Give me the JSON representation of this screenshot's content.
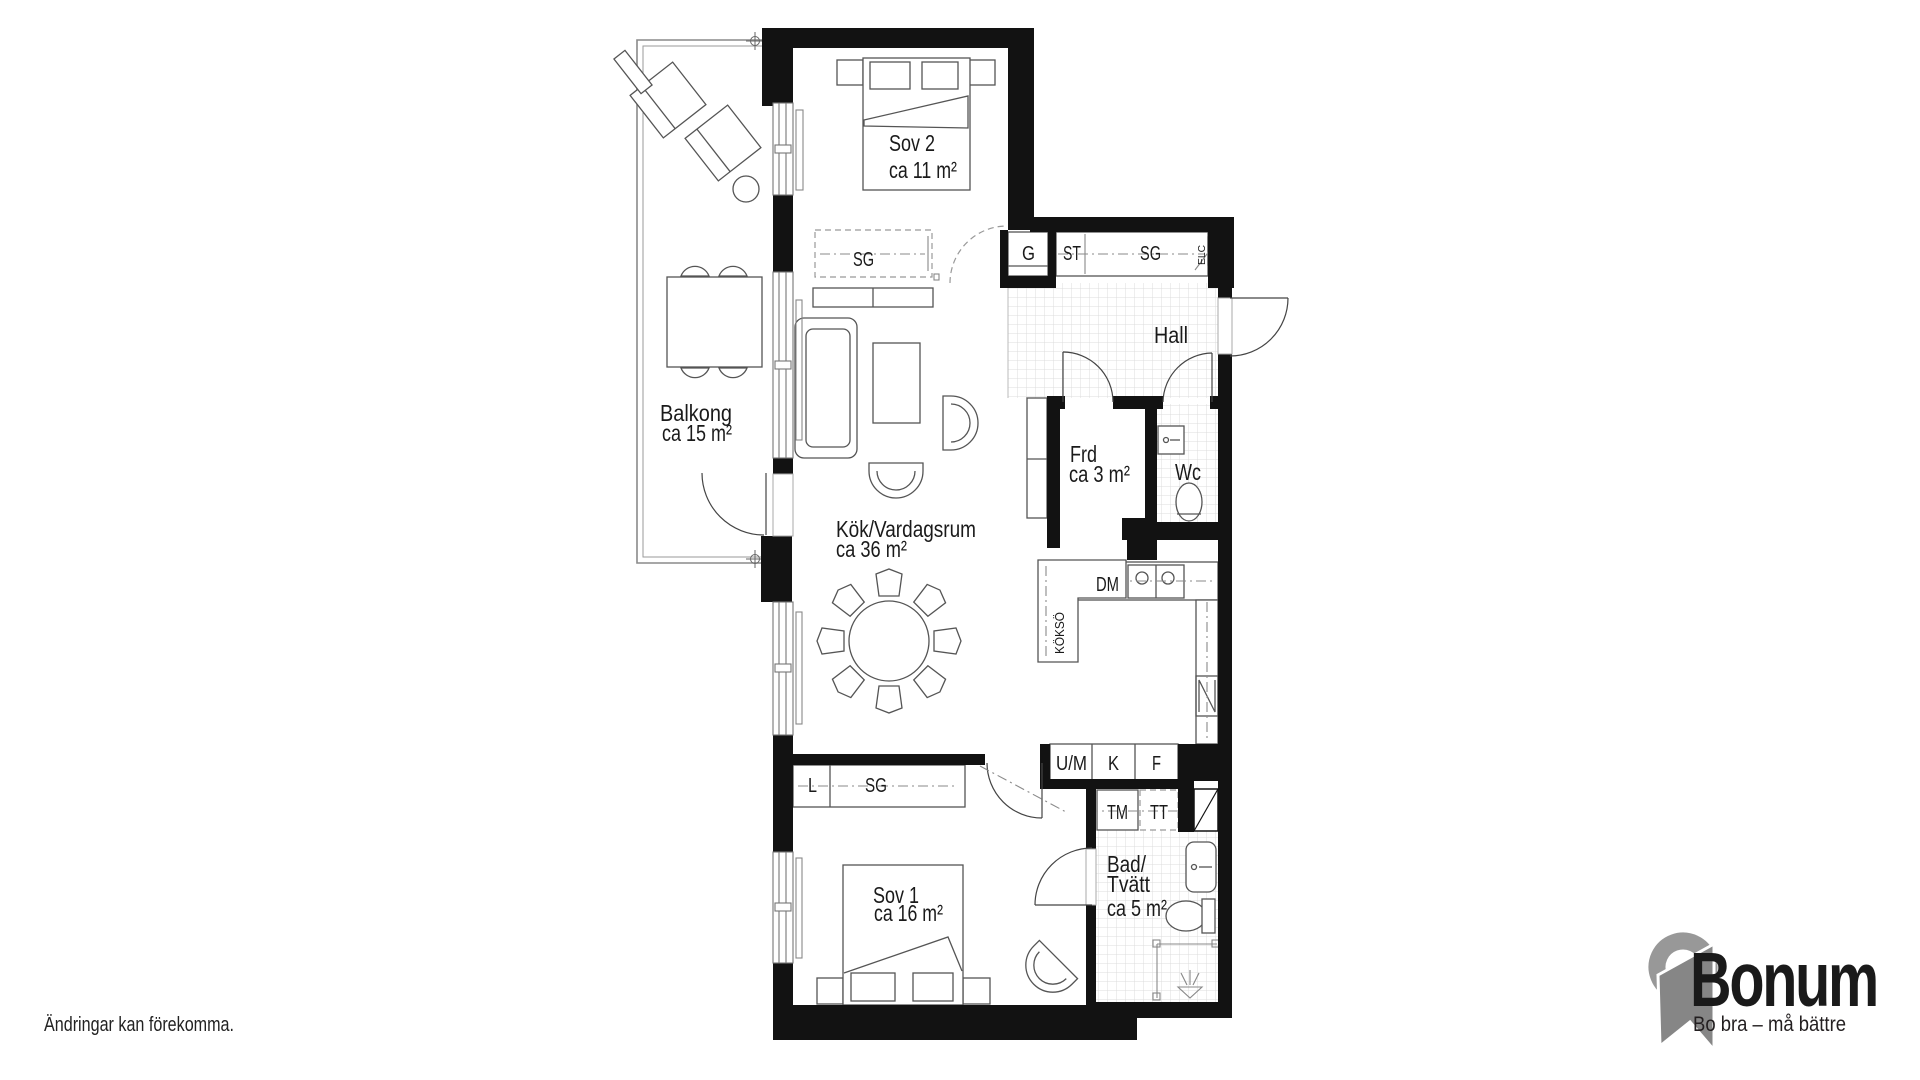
{
  "plan": {
    "disclaimer": "Ändringar kan förekomma.",
    "rooms": {
      "sov2": {
        "name": "Sov 2",
        "area": "ca 11 m²"
      },
      "balkong": {
        "name": "Balkong",
        "area": "ca 15 m²"
      },
      "kok": {
        "name": "Kök/Vardagsrum",
        "area": "ca 36 m²"
      },
      "hall": {
        "name": "Hall"
      },
      "frd": {
        "name": "Frd",
        "area": "ca 3 m²"
      },
      "wc": {
        "name": "Wc"
      },
      "sov1": {
        "name": "Sov 1",
        "area": "ca 16 m²"
      },
      "bad": {
        "line1": "Bad/",
        "line2": "Tvätt",
        "area": "ca 5 m²"
      }
    },
    "labels": {
      "g": "G",
      "st": "ST",
      "sg_hall": "SG",
      "elc": "ELC",
      "sg_sov2": "SG",
      "dm": "DM",
      "kokso": "KÖKSÖ",
      "um": "U/M",
      "kyl": "K",
      "frys": "F",
      "tm": "TM",
      "tt": "TT",
      "l": "L",
      "sg_sov1": "SG"
    }
  },
  "brand": {
    "name": "Bonum",
    "tagline": "Bo bra – må bättre",
    "orange": "#F5A11E",
    "gray": "#8E8E8E"
  }
}
